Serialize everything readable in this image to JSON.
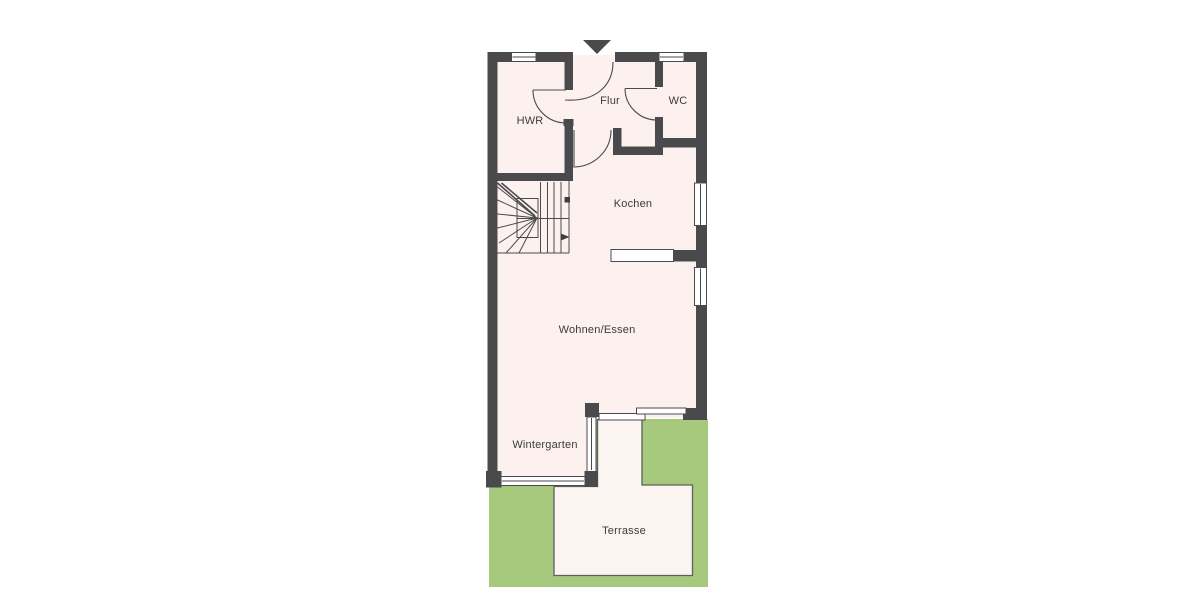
{
  "plan": {
    "type": "residential-floor-plan-ground-floor",
    "rooms": [
      {
        "id": "hwr",
        "label": "HWR"
      },
      {
        "id": "flur",
        "label": "Flur"
      },
      {
        "id": "wc",
        "label": "WC"
      },
      {
        "id": "kochen",
        "label": "Kochen"
      },
      {
        "id": "wohnen_essen",
        "label": "Wohnen/Essen"
      },
      {
        "id": "wintergarten",
        "label": "Wintergarten"
      },
      {
        "id": "terrasse",
        "label": "Terrasse"
      }
    ],
    "markers": {
      "entrance_arrow": "entrance-direction-marker",
      "stair_direction": "stair-up-arrow"
    },
    "colors": {
      "background": "#ffffff",
      "floor": "#fdf1ef",
      "lawn": "#a6c97d",
      "wall": "#4a4a4c",
      "glass": "#ffffff",
      "terrace": "#fbf4f1",
      "terrace_outline": "#5d6156",
      "text": "#3b3b3b"
    }
  }
}
